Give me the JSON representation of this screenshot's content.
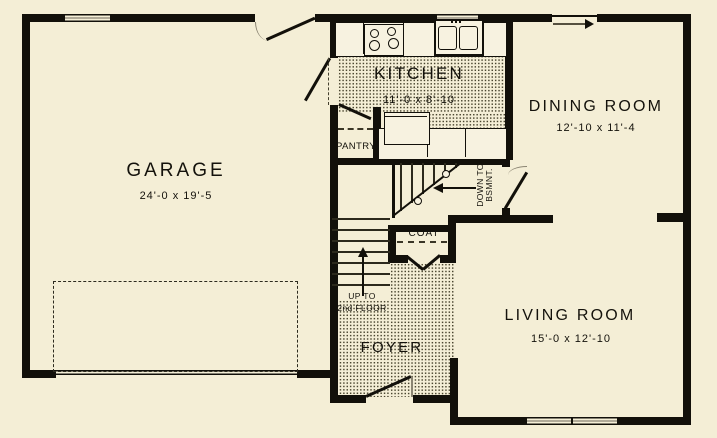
{
  "colors": {
    "background": "#f4eed6",
    "wall": "#12100a",
    "floor_dot": "#49452f",
    "fixture_fill": "#f7f2e0"
  },
  "rooms": {
    "garage": {
      "name": "GARAGE",
      "dims": "24'-0 x 19'-5"
    },
    "kitchen": {
      "name": "KITCHEN",
      "dims": "11'-0 x 8'-10"
    },
    "dining": {
      "name": "DINING ROOM",
      "dims": "12'-10 x 11'-4"
    },
    "living": {
      "name": "LIVING ROOM",
      "dims": "15'-0 x 12'-10"
    },
    "foyer": {
      "name": "FOYER"
    },
    "pantry": {
      "name": "PANTRY"
    },
    "coat": {
      "name": "COAT"
    }
  },
  "stairs": {
    "up_line1": "UP TO",
    "up_line2": "2nd FLOOR",
    "down_line1": "DOWN TO",
    "down_line2": "BSMNT."
  }
}
